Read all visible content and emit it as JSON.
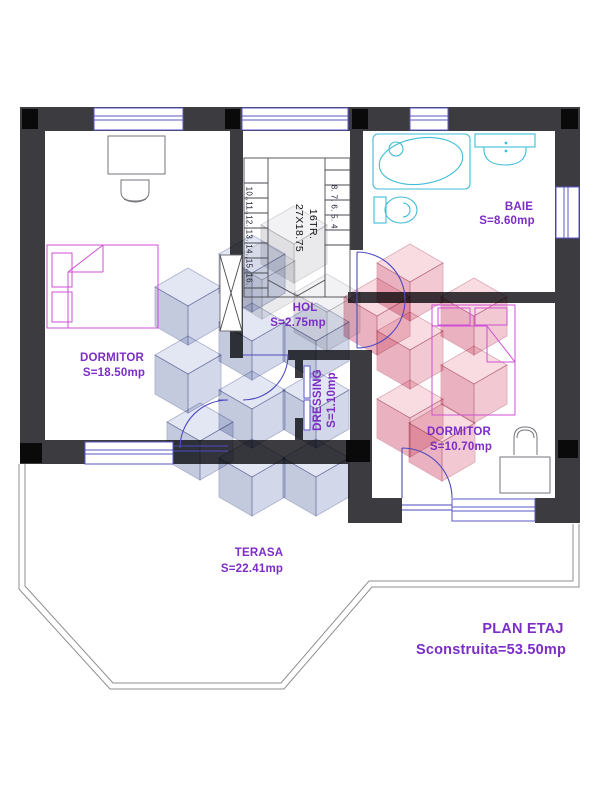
{
  "title": {
    "line1": "PLAN ETAJ",
    "line2": "Sconstruita=53.50mp"
  },
  "rooms": {
    "dormitor_left": {
      "name": "DORMITOR",
      "area": "S=18.50mp"
    },
    "baie": {
      "name": "BAIE",
      "area": "S=8.60mp"
    },
    "hol": {
      "name": "HOL",
      "area": "S=2.75mp"
    },
    "dressing": {
      "name": "DRESSING",
      "area": "S=1.10mp"
    },
    "dormitor_right": {
      "name": "DORMITOR",
      "area": "S=10.70mp"
    },
    "terasa": {
      "name": "TERASA",
      "area": "S=22.41mp"
    }
  },
  "staircase": {
    "label": "16TR.",
    "tread_size": "27X18.75",
    "treads_upper": "10.,11.,12.,13.,14.,15.,16.",
    "treads_lower": "8.  7.  6.  5.  4."
  },
  "colors": {
    "label_text": "#7c2dc6",
    "walls": "#3c3c40",
    "windows_doors": "#5a57c8",
    "bathroom_fixtures": "#3fbdd6",
    "beds": "#cf4fd4",
    "furniture": "#76767c",
    "watermark_blue": "#c7cde6",
    "watermark_pink": "#f2c3ce"
  }
}
